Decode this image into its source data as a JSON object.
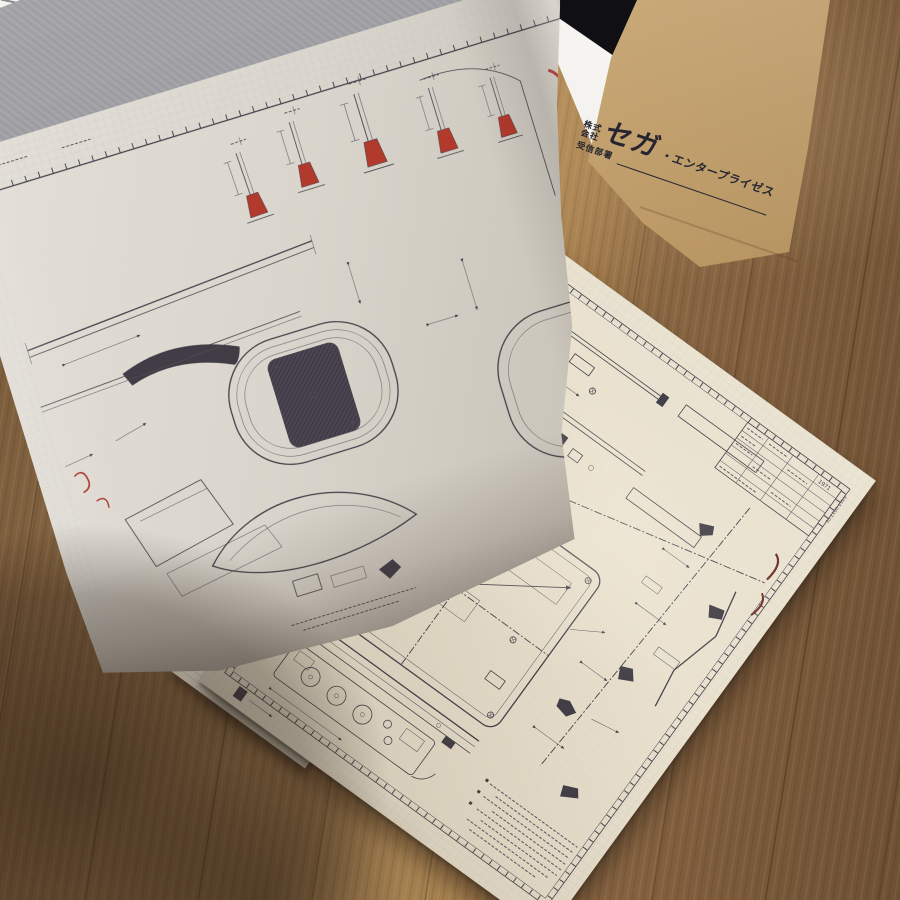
{
  "scene": {
    "subject": "Open book of Sega arcade-cabinet engineering blueprints lying on a wooden table, one page mid-turn, with a kraft envelope printed with the Sega Enterprises logo at top right"
  },
  "envelope": {
    "company_prefix_line1": "株式",
    "company_prefix_line2": "会社",
    "logo_text": "セガ",
    "logo_suffix": "・エンタープライゼス",
    "department_label": "受信部署",
    "kraft_color": "#c7a36e",
    "print_color": "#26252f"
  },
  "flat_page": {
    "paper_color": "#eae2cf",
    "grid_color": "#9fb6bf",
    "ink_color": "#44404a",
    "highlight_pink": "#e59a90",
    "title_block": {
      "year": "1971",
      "drawing_no": "A4A4-0017-01"
    }
  },
  "lifted_page": {
    "paper_color": "#d9d5cc",
    "red_accent": "#a83226"
  },
  "table": {
    "wood_color": "#8b6a45"
  }
}
